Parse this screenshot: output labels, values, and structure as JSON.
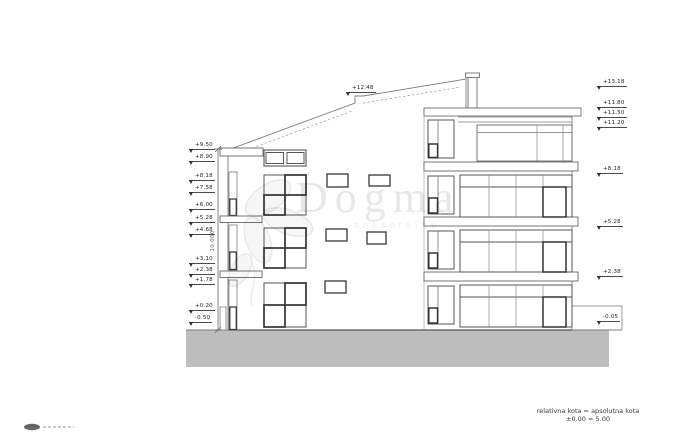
{
  "watermark": {
    "brand": "Dogma",
    "subtext": "nekretnine"
  },
  "legend": {
    "line1": "relativna kota = apsolutna kota",
    "line2": "±0.00 = 5.00"
  },
  "dimensions": {
    "overall_height": "10.000",
    "roof_step_level": "+12.48"
  },
  "elevations": {
    "left": [
      "+9.50",
      "+8.90",
      "+8.18",
      "+7.58",
      "+6.00",
      "+5.28",
      "+4.68",
      "+3.10",
      "+2.38",
      "+1.78",
      "+0.20",
      "-0.50"
    ],
    "right": [
      "+13.18",
      "+11.80",
      "+11.50",
      "+11.20",
      "+8.18",
      "+5.28",
      "+2.38",
      "-0.05"
    ]
  },
  "colors": {
    "line": "#7d7d7d",
    "dark": "#3c3c3c",
    "ground_fill": "#bdbdbd",
    "marker_text": "#1f1f1f"
  }
}
